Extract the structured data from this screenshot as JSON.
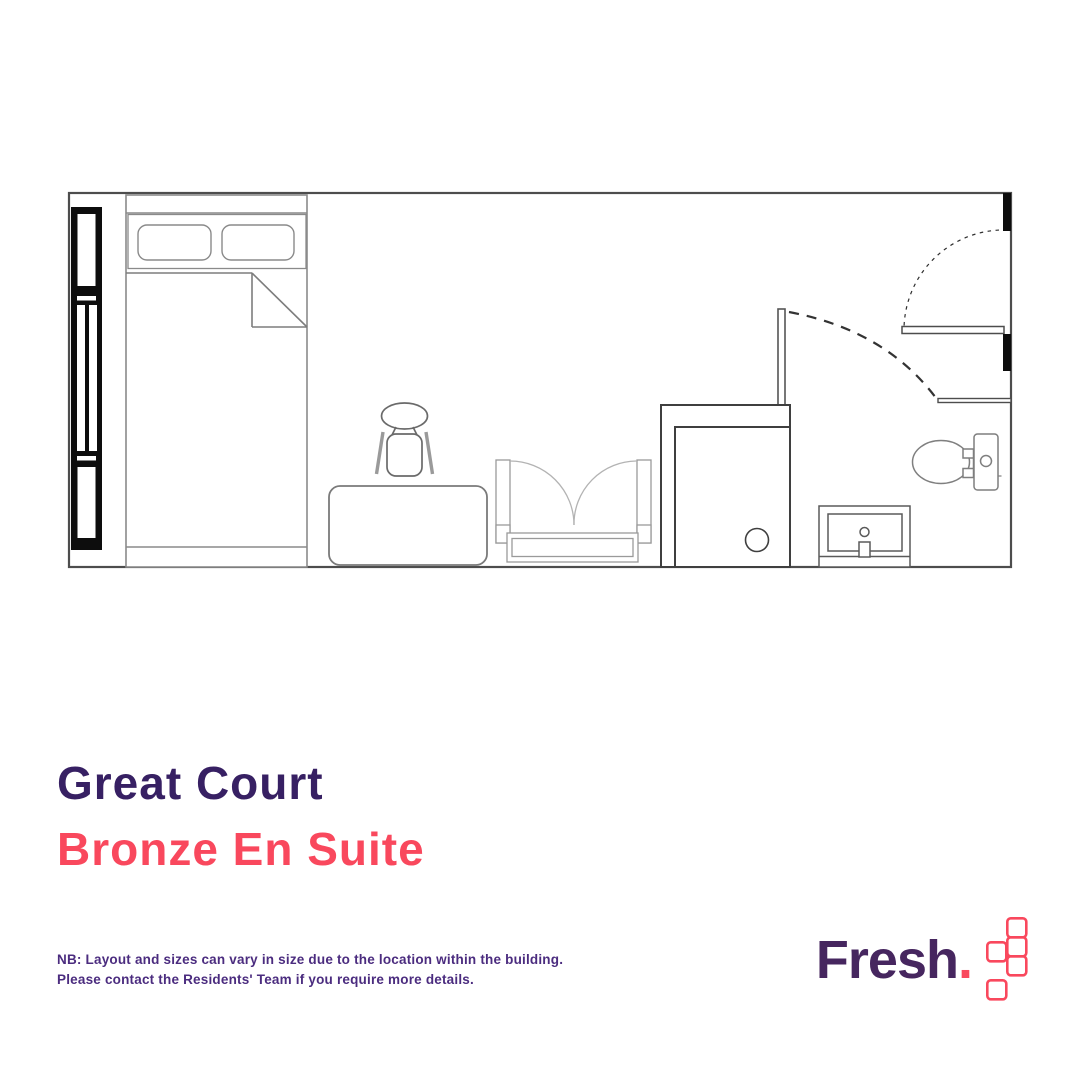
{
  "page": {
    "background": "#ffffff"
  },
  "titles": {
    "building": "Great Court",
    "room": "Bronze En Suite",
    "building_color": "#372063",
    "room_color": "#f9485d"
  },
  "note": {
    "line1": "NB: Layout and sizes can vary in size due to the location within the building.",
    "line2": "Please contact the Residents' Team if you require more details.",
    "color": "#4b2c7f"
  },
  "brand": {
    "wordmark": "Fresh",
    "wordmark_suffix": ".",
    "wordmark_color": "#46265f",
    "accent_color": "#f9485d",
    "mark": "five-outlined-squares-zigzag"
  },
  "floorplan": {
    "description": "Top-view floor plan of a studio en-suite room",
    "wall_color": "#4d4d4d",
    "window_color": "#000000",
    "elements": [
      "window",
      "bed",
      "pillows",
      "folded-sheet",
      "desk",
      "desk-chair",
      "wardrobe-open-doors",
      "partition-wall",
      "shower",
      "bathroom-door",
      "entrance-door",
      "wash-basin",
      "toilet"
    ]
  }
}
